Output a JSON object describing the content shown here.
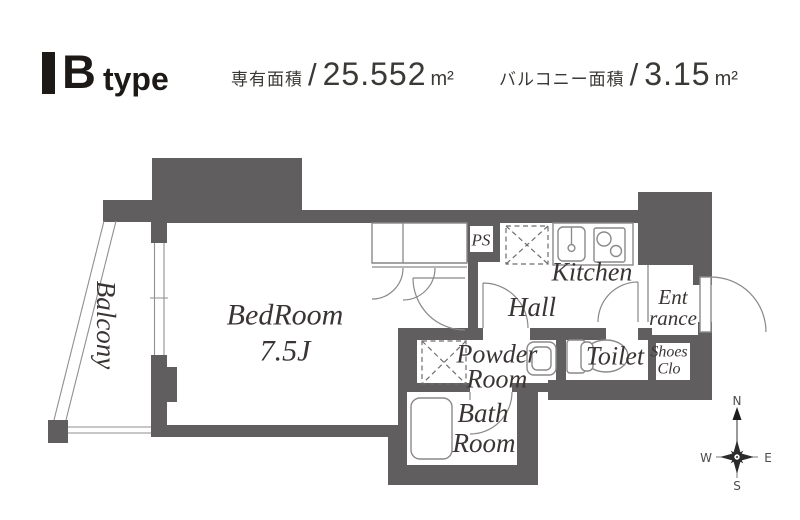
{
  "header": {
    "type_label": "B",
    "type_suffix": "type",
    "area1": {
      "label": "専有面積",
      "sep": "/",
      "value": "25.552",
      "unit": "m²"
    },
    "area2": {
      "label": "バルコニー面積",
      "sep": "/",
      "value": "3.15",
      "unit": "m²"
    }
  },
  "rooms": {
    "balcony": {
      "label": "Balcony"
    },
    "bedroom": {
      "line1": "BedRoom",
      "line2": "7.5J"
    },
    "kitchen": {
      "label": "Kitchen"
    },
    "hall": {
      "label": "Hall"
    },
    "powder": {
      "line1": "Powder",
      "line2": "Room"
    },
    "bath": {
      "line1": "Bath",
      "line2": "Room"
    },
    "toilet": {
      "label": "Toilet"
    },
    "entrance": {
      "line1": "Ent",
      "line2": "rance"
    },
    "shoes": {
      "line1": "Shoes",
      "line2": "Clo"
    },
    "ps": {
      "label": "PS"
    }
  },
  "compass": {
    "n": "N",
    "s": "S",
    "e": "E",
    "w": "W"
  },
  "colors": {
    "wall": "#605e5e",
    "thin_line": "#8a8888",
    "label_text": "#3a3534",
    "header_text": "#1d1916",
    "dashed": "#6f6d6d"
  }
}
